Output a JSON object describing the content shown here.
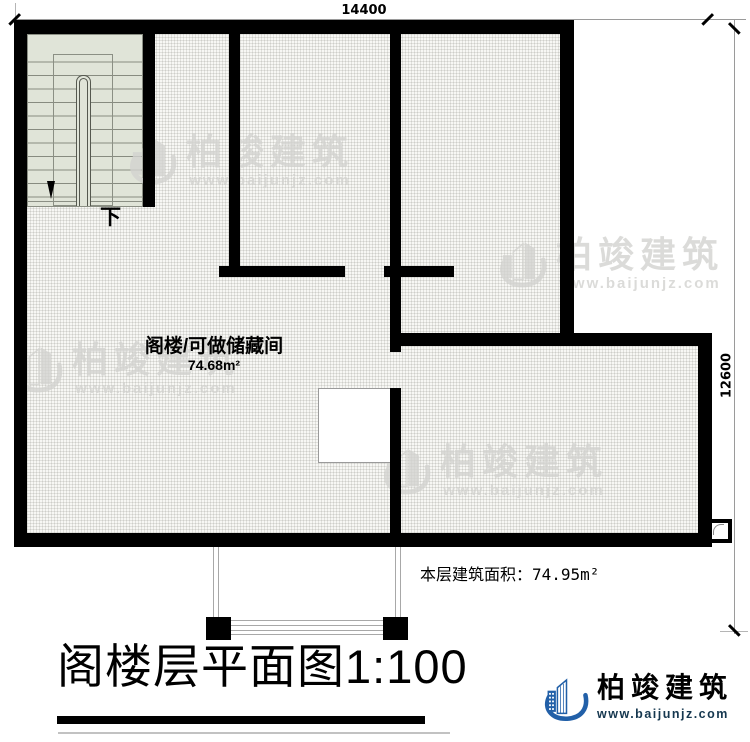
{
  "plan": {
    "dim_width": "14400",
    "dim_height": "12600",
    "room": {
      "name": "阁楼/可做储藏间",
      "area": "74.68m²"
    },
    "stair_down_label": "下",
    "area_note": "本层建筑面积：74.95m²"
  },
  "title": {
    "main": "阁楼层平面图",
    "scale": "1:100"
  },
  "brand": {
    "name": "柏竣建筑",
    "url": "www.baijunjz.com"
  },
  "watermark": {
    "name": "柏竣建筑",
    "url": "www.baijunjz.com"
  },
  "colors": {
    "wall": "#000000",
    "stair_fill": "#e0e4d8",
    "hatch_bg": "#f7f7f4",
    "watermark_gray": "#d3d3d0",
    "brand_blue": "#2260a8",
    "brand_orange": "#ef7d00",
    "url_navy": "#15374f"
  }
}
